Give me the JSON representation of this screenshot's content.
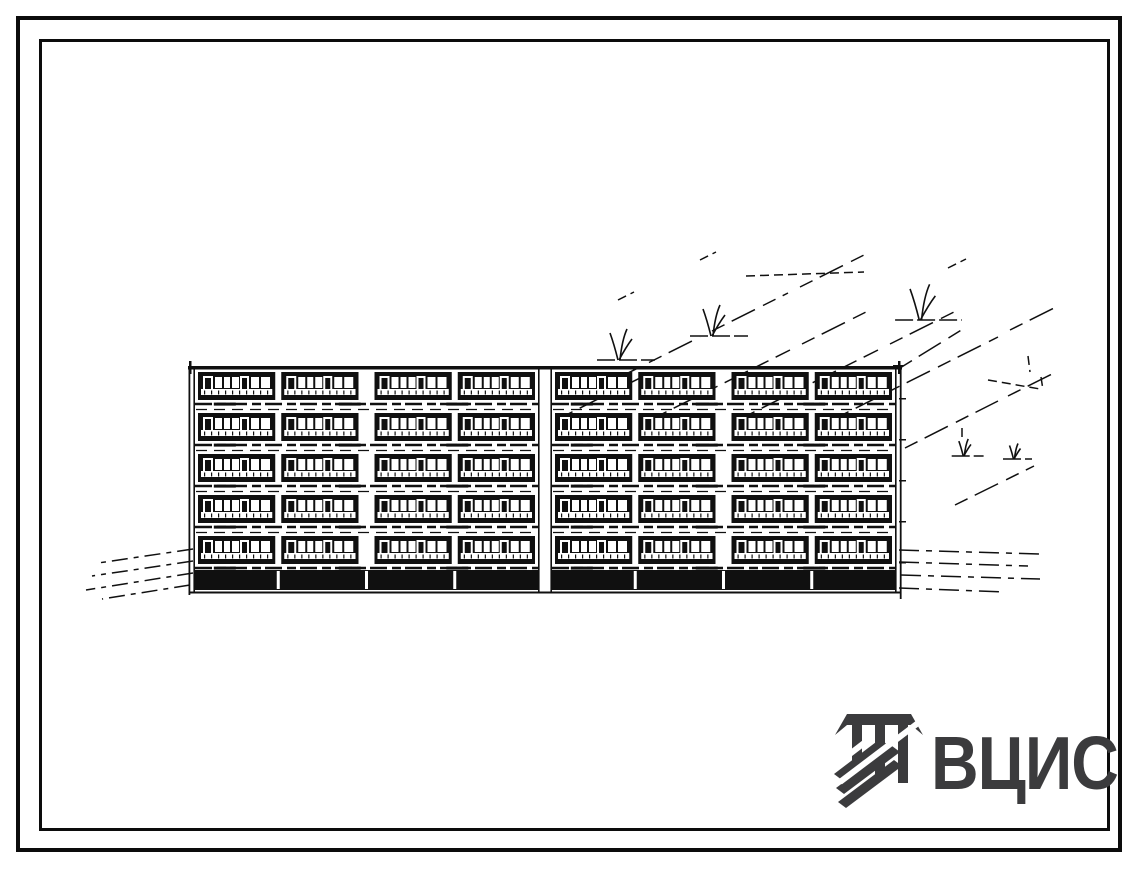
{
  "page": {
    "background": "#ffffff",
    "frame_color": "#0c0c0c"
  },
  "logo": {
    "text": "ВЦИС",
    "color": "#3b3b3d"
  },
  "drawing": {
    "ink": "#101010",
    "paper": "#ffffff",
    "building": {
      "floors": 5,
      "sections": 2,
      "bays_per_section": 4,
      "left": 193,
      "right": 897,
      "roof_y": 366,
      "band_top": 372,
      "floor_pitch": 41,
      "band_height": 28,
      "plinth_top": 570,
      "plinth_bottom": 590,
      "base_y": 593,
      "seam_width": 10,
      "edge_margin": 5,
      "pilaster": 6,
      "wide_pilaster": 16
    },
    "landscape": {
      "diagonals": [
        [
          598,
          388,
          700,
          337
        ],
        [
          712,
          331,
          788,
          293
        ],
        [
          800,
          287,
          866,
          254
        ],
        [
          560,
          418,
          642,
          377
        ],
        [
          654,
          418,
          790,
          350
        ],
        [
          802,
          344,
          870,
          310
        ],
        [
          742,
          418,
          878,
          350
        ],
        [
          890,
          344,
          960,
          309
        ],
        [
          836,
          418,
          998,
          337
        ],
        [
          1010,
          330,
          1058,
          306
        ],
        [
          905,
          448,
          998,
          401
        ],
        [
          1008,
          396,
          1054,
          373
        ],
        [
          955,
          505,
          1034,
          466
        ],
        [
          900,
          368,
          963,
          329
        ]
      ],
      "dash_bits": [
        [
          746,
          276,
          864,
          272
        ],
        [
          988,
          380,
          1040,
          389
        ],
        [
          1041,
          377,
          1043,
          390
        ],
        [
          962,
          428,
          962,
          440
        ],
        [
          1028,
          356,
          1030,
          372
        ],
        [
          618,
          300,
          634,
          292
        ],
        [
          700,
          260,
          716,
          252
        ],
        [
          948,
          268,
          966,
          259
        ]
      ],
      "trees": [
        {
          "x": 623,
          "y": 360,
          "s": 1
        },
        {
          "x": 716,
          "y": 336,
          "s": 1
        },
        {
          "x": 925,
          "y": 320,
          "s": 1.15
        },
        {
          "x": 966,
          "y": 456,
          "s": 0.55
        },
        {
          "x": 1016,
          "y": 459,
          "s": 0.5
        }
      ]
    },
    "ground": {
      "left": [
        [
          193,
          549,
          98,
          563
        ],
        [
          193,
          561,
          92,
          576
        ],
        [
          193,
          573,
          86,
          590
        ],
        [
          190,
          585,
          102,
          599
        ]
      ],
      "right": [
        [
          899,
          550,
          1040,
          554
        ],
        [
          899,
          562,
          1028,
          566
        ],
        [
          901,
          575,
          1040,
          579
        ],
        [
          899,
          588,
          1005,
          592
        ]
      ]
    }
  }
}
